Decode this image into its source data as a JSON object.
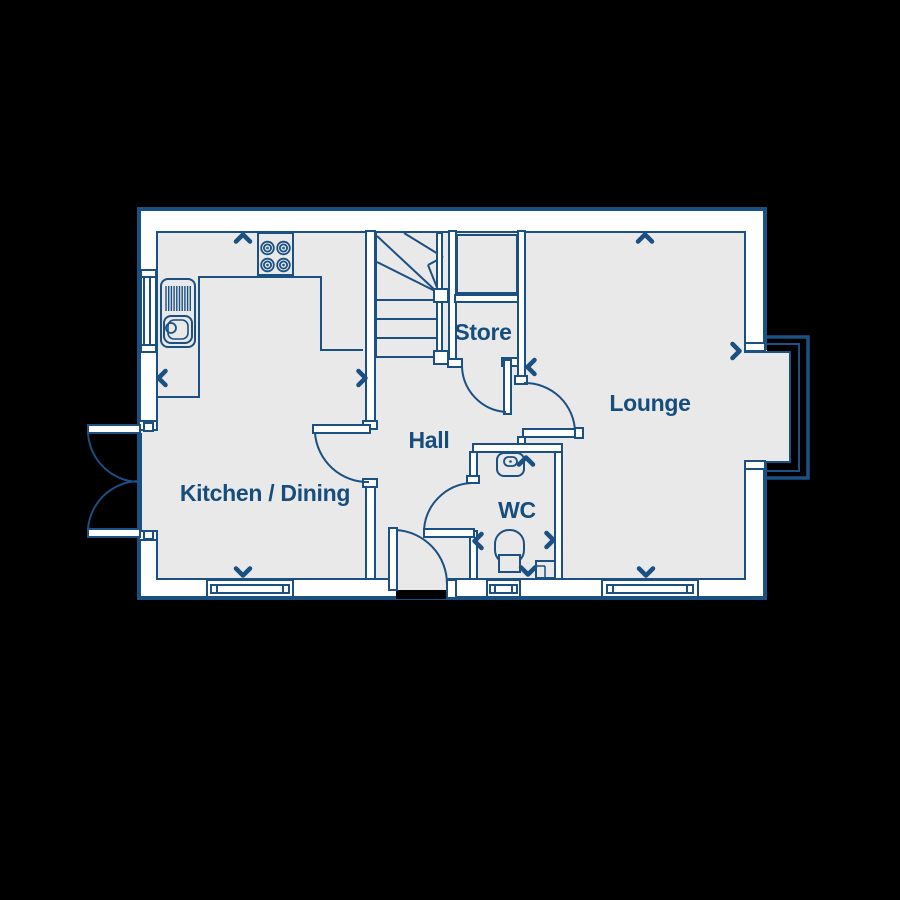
{
  "colors": {
    "background": "#000000",
    "wall": "#ffffff",
    "floor": "#e9e9ea",
    "line": "#1a5082",
    "text": "#164d7d"
  },
  "rooms": {
    "kitchen_dining": {
      "label": "Kitchen / Dining"
    },
    "hall": {
      "label": "Hall"
    },
    "store": {
      "label": "Store"
    },
    "wc": {
      "label": "WC"
    },
    "lounge": {
      "label": "Lounge"
    }
  },
  "fixtures": [
    "sink-drainer-unit",
    "hob-4-ring",
    "worktop",
    "stairs-with-winders",
    "store-cupboard",
    "wash-basin",
    "toilet",
    "boxed-duct",
    "french-doors",
    "front-door",
    "internal-doors",
    "bay-window",
    "kitchen-window",
    "wc-window",
    "lounge-window",
    "side-window"
  ],
  "dimension_markers": {
    "kitchen_dining": [
      "up",
      "left",
      "right",
      "down"
    ],
    "lounge": [
      "up",
      "left",
      "right",
      "down"
    ],
    "wc": [
      "up",
      "left",
      "right",
      "down"
    ]
  }
}
